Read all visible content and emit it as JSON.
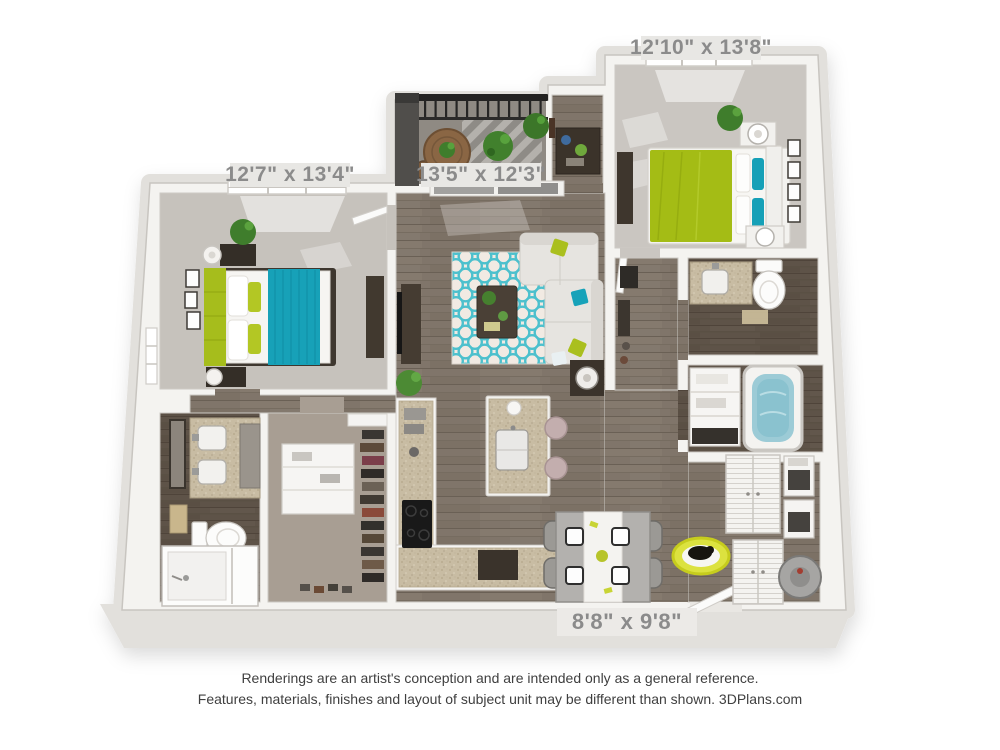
{
  "page": {
    "background_color": "#ffffff",
    "description": "3D rendered two-bedroom apartment floor plan"
  },
  "floor_plan": {
    "room_labels": [
      {
        "room": "bedroom-right",
        "dimensions": "12'10\" x 13'8\""
      },
      {
        "room": "bedroom-left",
        "dimensions": "12'7\" x 13'4\""
      },
      {
        "room": "living-room",
        "dimensions": "13'5\" x 12'3\""
      },
      {
        "room": "dining-area",
        "dimensions": "8'8\" x 9'8\""
      }
    ],
    "palette": {
      "accent_teal": "#17a1b8",
      "accent_lime": "#a6bd1c",
      "rug_teal": "#4cc0cd",
      "wood_floor": "#80756a",
      "dark_wood_floor": "#5e5348",
      "carpet": "#c6c2bc",
      "closet_carpet": "#a89e93",
      "walls": "#f4f3f0",
      "platform": "#e2e0dc",
      "granite": "#c8bca3",
      "label_text": "#8b8b8b",
      "label_background": "#e8e7e4",
      "railing": "#262524",
      "tub_water": "#9ccbd6"
    }
  },
  "disclaimer": {
    "line1": "Renderings are an artist's conception and are intended only as a general reference.",
    "line2": "Features, materials, finishes and layout of subject unit may be different than shown. 3DPlans.com"
  }
}
